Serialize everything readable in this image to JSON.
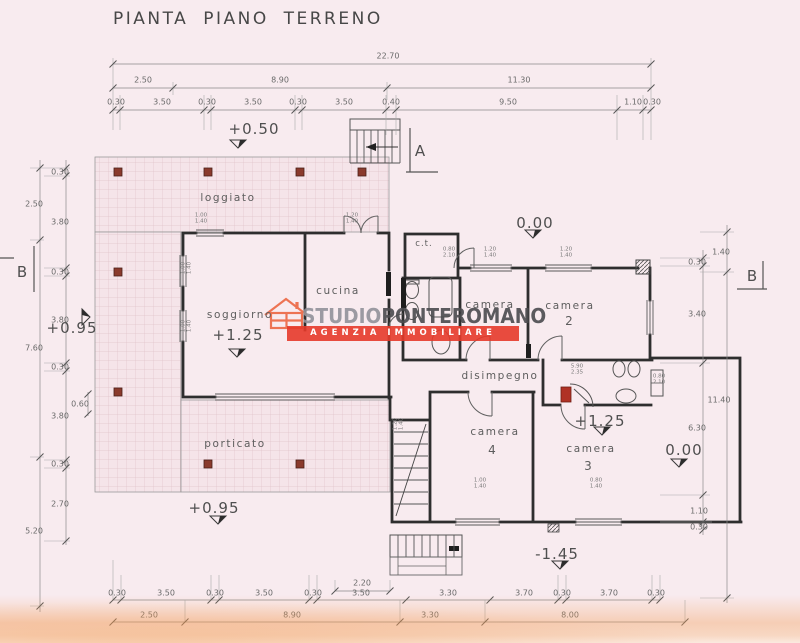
{
  "title": "PIANTA PIANO TERRENO",
  "watermark": {
    "studio": "STUDIO",
    "agency": "PONTEROMANO",
    "banner": "AGENZIA IMMOBILIARE",
    "accent_color": "#e63a2a",
    "icon": "house-icon"
  },
  "sections": {
    "a": "A",
    "b_left": "B",
    "b_right": "B"
  },
  "levels": {
    "loggiato_up": "+0.50",
    "terrace_top": "0.00",
    "soggiorno": "+1.25",
    "camera3": "+1.25",
    "terrace_right": "0.00",
    "left_side": "+0.95",
    "porticato": "+0.95",
    "external_stair": "-1.45"
  },
  "rooms": {
    "loggiato": "loggiato",
    "porticato": "porticato",
    "soggiorno": "soggiorno",
    "cucina": "cucina",
    "ct": "c.t.",
    "camera1": "camera",
    "camera2": "camera",
    "camera2_num": "2",
    "disimpegno": "disimpegno",
    "camera4": "camera",
    "camera4_num": "4",
    "camera3": "camera",
    "camera3_num": "3"
  },
  "dims": {
    "top_total": "22.70",
    "top_mid": [
      "2.50",
      "8.90",
      "11.30"
    ],
    "top_detail": [
      "0.30",
      "3.50",
      "0.30",
      "3.50",
      "0.30",
      "3.50",
      "0.40",
      "9.50",
      "1.10",
      "0.30"
    ],
    "left_outer": [
      "2.50",
      "7.60",
      "5.20"
    ],
    "left_detail": [
      "0.30",
      "3.80",
      "0.30",
      "3.80",
      "0.30",
      "3.80",
      "0.30",
      "2.70"
    ],
    "left_small": "0.60",
    "right_outer": [
      "1.40",
      "11.40"
    ],
    "right_detail": [
      "0.30",
      "3.40",
      "6.30",
      "1.10",
      "0.30"
    ],
    "bottom_small": "2.20",
    "bottom_detail": [
      "0.30",
      "3.50",
      "0.30",
      "3.50",
      "0.30",
      "3.50",
      "3.30",
      "3.70",
      "0.30",
      "3.70",
      "0.30"
    ],
    "bottom_mid": [
      "2.50",
      "8.90",
      "3.30",
      "8.00"
    ]
  },
  "window_tags": [
    "1.00\n1.40",
    "1.20\n1.40",
    "1.20\n1.40",
    "1.20\n1.40",
    "0.80\n2.10",
    "1.00\n1.40",
    "1.00\n1.40",
    "1.00\n1.40",
    "0.80\n1.40",
    "0.80\n2.10",
    "5.90\n2.35",
    "1.20\n1.40"
  ]
}
